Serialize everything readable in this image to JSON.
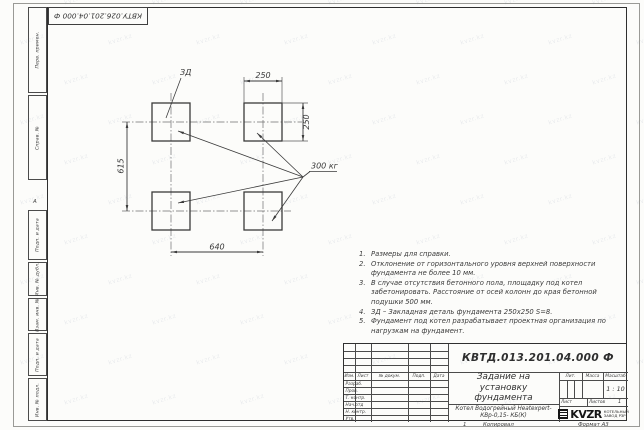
{
  "sheet": {
    "stamp_top": "КВТУ.026.201.04.000 Ф",
    "zone_marker": "А",
    "margin_labels": [
      "Перв. примен.",
      "Справ. №",
      "Подп. и дата",
      "Инв. № дубл.",
      "Взам. инв. №",
      "Подп. и дата",
      "Инв. № подл."
    ],
    "footer": {
      "page_mark": "1",
      "copy_label": "Копировал",
      "format_label": "Формат А3"
    }
  },
  "drawing": {
    "dim_top": "250",
    "dim_right": "250",
    "dim_left": "615",
    "dim_bottom": "640",
    "detail_label": "ЗД",
    "load_label": "300 кг"
  },
  "notes": [
    {
      "n": "1.",
      "t": "Размеры для справки."
    },
    {
      "n": "2.",
      "t": "Отклонение от горизонтального уровня верхней поверхности фундамента не более 10 мм."
    },
    {
      "n": "3.",
      "t": "В случае отсутствия бетонного пола, площадку под котел забетонировать. Расстояние от осей колонн до края бетонной подушки 500 мм."
    },
    {
      "n": "4.",
      "t": "ЗД – Закладная деталь фундамента 250х250 S=8."
    },
    {
      "n": "5.",
      "t": "Фундамент под котел разрабатывает проектная организация по нагрузкам на фундамент."
    }
  ],
  "title_block": {
    "doc_number": "КВТД.013.201.04.000 Ф",
    "title": "Задание на установку фундамента",
    "product": "Котел Водогрейный Heatexpert-КВр-0,15- КБ(К)",
    "header_cols": [
      "Изм.",
      "Лист",
      "№ докум.",
      "Подп.",
      "Дата"
    ],
    "row_labels": [
      "Разраб.",
      "Пров.",
      "Т. контр.",
      "Нач.отд",
      "Н. контр.",
      "Утв."
    ],
    "lit_label": "Лит.",
    "mass_label": "Масса",
    "scale_label": "Масштаб",
    "scale_value": "1 : 10",
    "sheet_label": "Лист",
    "sheets_label": "Листов",
    "sheets_value": "1",
    "logo_text": "KVZR",
    "company_line1": "КОТЕЛЬНЫЙ",
    "company_line2": "ЗАВОД РЗР"
  },
  "watermark": {
    "text": "kvzr.kz"
  },
  "colors": {
    "line_dark": "#3a3a3a",
    "line_thin": "#6f6f6f",
    "text": "#3b3b3b",
    "logo": "#151515"
  }
}
